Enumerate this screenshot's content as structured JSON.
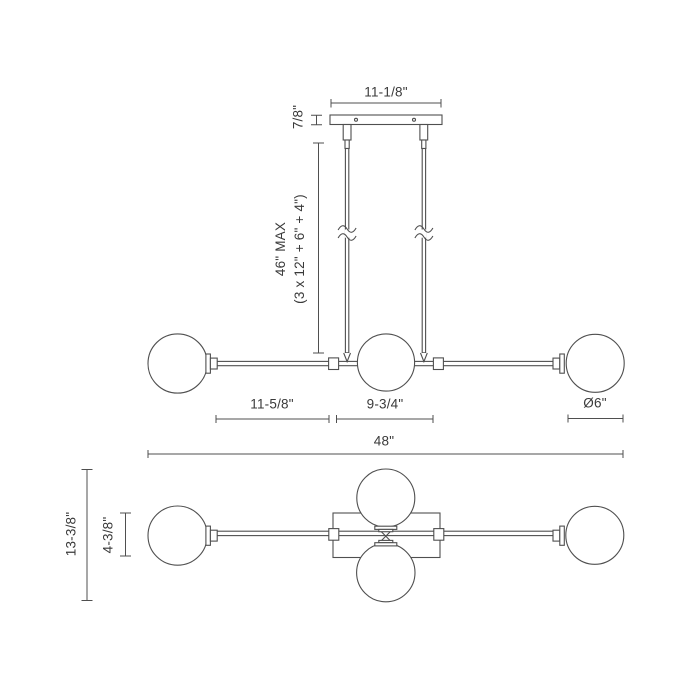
{
  "side_view": {
    "canopy_width": "11-1/8\"",
    "canopy_height": "7/8\"",
    "max_drop_line1": "46\" MAX",
    "max_drop_line2": "(3 x 12\" + 6\" + 4\")",
    "left_arm_span": "11-5/8\"",
    "center_span": "9-3/4\"",
    "globe_diameter": "Ø6\"",
    "overall_width": "48\""
  },
  "bottom_view": {
    "overall_depth": "13-3/8\"",
    "canopy_depth": "4-3/8\""
  },
  "colors": {
    "line": "#4f4f4f",
    "text": "#3a3a3a",
    "background": "#ffffff"
  }
}
